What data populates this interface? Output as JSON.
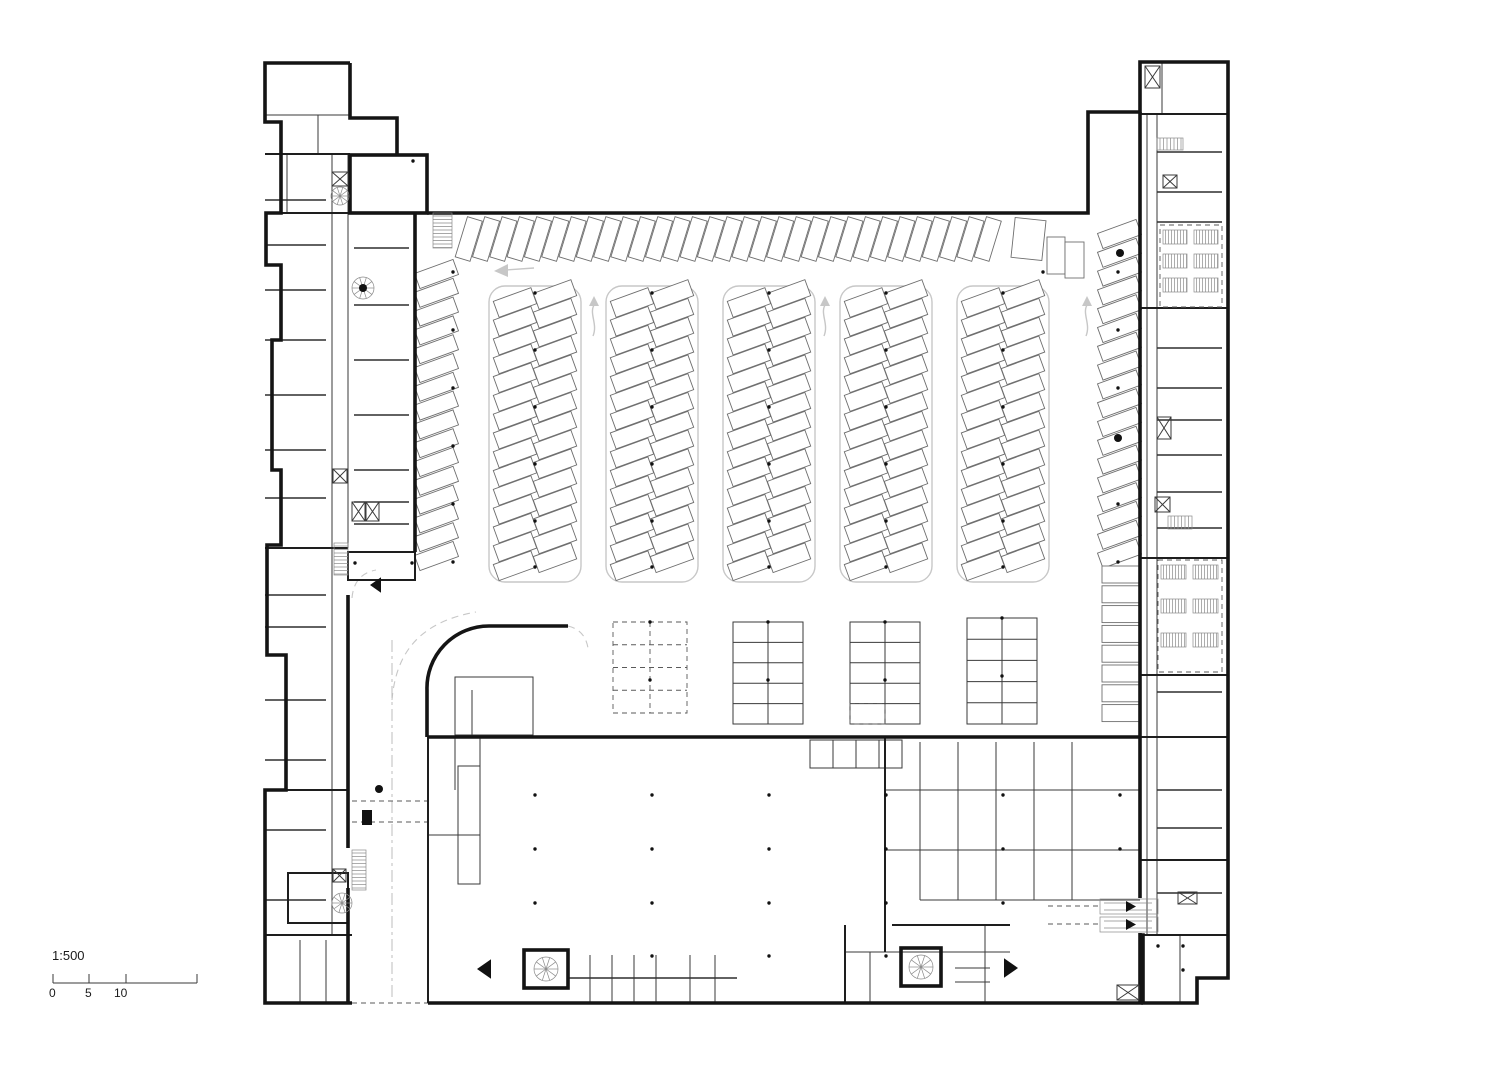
{
  "meta": {
    "drawing_type": "architectural floor plan, parking level",
    "background": "#ffffff",
    "ink": "#141414",
    "light_gray": "#c7c7c7"
  },
  "scale_bar": {
    "ratio": "1:500",
    "ticks": [
      "0",
      "5",
      "10"
    ],
    "bar": {
      "x1": 53,
      "x2": 197,
      "y": 983,
      "tick_xs": [
        53,
        89,
        126,
        197
      ],
      "tick_h": 9
    }
  },
  "plan": {
    "paths4": [
      "M350,63 H265 V122 H281 V213 H266 V265 H281 V340 H272 V470 H281 V545 H267 V655 H286 V790 H265 V1003 H352",
      "M350,63 V118 H397 V155",
      "M427,213 H1088 V112 H1140 V62 H1228 V978 H1197 V1003 H1143 V935 H1140",
      "M1140,112 V898 M1140,933 V1003",
      "M415,213 V552",
      "M428,1003 H1143",
      "M348,595 V848 M348,888 V1003",
      "M427,690 A62,62 0 0 1 489,626 M489,626 H568 M427,690 V737",
      "M428,737 H1140"
    ],
    "r4": [
      [
        350,
        155,
        77,
        58
      ],
      [
        524,
        950,
        44,
        38
      ],
      [
        901,
        948,
        40,
        38
      ]
    ],
    "w2": [
      [
        428,
        737,
        428,
        1003
      ],
      [
        265,
        213,
        415,
        213
      ],
      [
        265,
        154,
        350,
        154
      ],
      [
        265,
        548,
        348,
        548
      ],
      [
        265,
        790,
        348,
        790
      ],
      [
        265,
        935,
        352,
        935
      ],
      [
        1140,
        114,
        1228,
        114
      ],
      [
        1140,
        308,
        1228,
        308
      ],
      [
        1140,
        558,
        1228,
        558
      ],
      [
        1140,
        675,
        1228,
        675
      ],
      [
        1140,
        737,
        1228,
        737
      ],
      [
        1140,
        860,
        1228,
        860
      ],
      [
        1140,
        935,
        1228,
        935
      ],
      [
        885,
        737,
        885,
        952
      ],
      [
        845,
        925,
        845,
        1003
      ],
      [
        892,
        925,
        1010,
        925
      ]
    ],
    "r2": [
      [
        288,
        873,
        60,
        50
      ],
      [
        348,
        552,
        67,
        28
      ]
    ],
    "w1": [
      [
        332,
        155,
        332,
        935
      ],
      [
        348,
        155,
        348,
        548
      ],
      [
        1147,
        114,
        1147,
        935
      ],
      [
        1157,
        114,
        1157,
        935
      ],
      [
        265,
        115,
        350,
        115
      ],
      [
        318,
        115,
        318,
        155
      ],
      [
        287,
        154,
        287,
        213
      ],
      [
        1162,
        62,
        1162,
        114
      ],
      [
        455,
        737,
        455,
        790
      ],
      [
        480,
        737,
        480,
        835
      ],
      [
        428,
        835,
        480,
        835
      ],
      [
        590,
        955,
        590,
        1003
      ],
      [
        612,
        955,
        612,
        1003
      ],
      [
        634,
        955,
        634,
        1003
      ],
      [
        656,
        955,
        656,
        1003
      ],
      [
        690,
        955,
        690,
        1003
      ],
      [
        715,
        955,
        715,
        1003
      ],
      [
        845,
        952,
        1010,
        952
      ],
      [
        870,
        952,
        870,
        1003
      ],
      [
        985,
        925,
        985,
        1003
      ],
      [
        920,
        742,
        920,
        900
      ],
      [
        958,
        742,
        958,
        900
      ],
      [
        996,
        742,
        996,
        900
      ],
      [
        1034,
        742,
        1034,
        900
      ],
      [
        1072,
        742,
        1072,
        900
      ],
      [
        885,
        790,
        1140,
        790
      ],
      [
        885,
        850,
        1140,
        850
      ],
      [
        920,
        900,
        1140,
        900
      ],
      [
        300,
        940,
        300,
        1003
      ],
      [
        326,
        940,
        326,
        1003
      ],
      [
        1180,
        935,
        1180,
        1003
      ],
      [
        833,
        740,
        833,
        768
      ],
      [
        856,
        740,
        856,
        768
      ],
      [
        879,
        740,
        879,
        768
      ],
      [
        472,
        690,
        472,
        737
      ],
      [
        955,
        968,
        990,
        968
      ],
      [
        955,
        982,
        990,
        982
      ]
    ],
    "r1": [
      [
        458,
        766,
        22,
        118
      ],
      [
        810,
        740,
        92,
        28
      ],
      [
        455,
        677,
        78,
        58
      ]
    ],
    "divGroups": [
      {
        "x1": 265,
        "x2": 326,
        "ys": [
          200,
          245,
          290,
          340,
          395,
          450,
          498,
          595,
          627,
          700,
          760,
          830,
          900
        ]
      },
      {
        "x1": 354,
        "x2": 409,
        "ys": [
          248,
          305,
          360,
          415,
          470,
          502,
          524
        ]
      },
      {
        "x1": 1157,
        "x2": 1222,
        "ys": [
          152,
          192,
          222,
          348,
          388,
          420,
          455,
          492,
          528,
          692,
          790,
          828,
          893
        ]
      },
      {
        "x1": 568,
        "x2": 737,
        "ys": [
          978
        ]
      }
    ],
    "islands": {
      "cx": [
        535,
        652,
        769,
        886,
        1003
      ],
      "outline": {
        "y": 286,
        "h": 296,
        "w": 92,
        "rx": 16
      },
      "stall_len": 40,
      "stall_wid": 17,
      "pitch": 18.8,
      "angle": -20,
      "left_y0": 294,
      "right_y0": 286,
      "count": 15,
      "dots_y": [
        293,
        350,
        407,
        464,
        521,
        567
      ]
    },
    "rows": [
      {
        "dir": "x",
        "x": 461,
        "y": 218,
        "len": 42,
        "wid": 15.5,
        "count": 31,
        "pitch": 17.3,
        "angle": 17
      },
      {
        "dir": "y",
        "x": 416,
        "y": 266,
        "len": 41,
        "wid": 16,
        "count": 16,
        "pitch": 18.8,
        "angle": -20
      },
      {
        "dir": "y",
        "x": 1099,
        "y": 226,
        "len": 41,
        "wid": 16,
        "count": 18,
        "pitch": 18.8,
        "angle": -20
      },
      {
        "dir": "y",
        "x": 1102,
        "y": 566,
        "len": 38,
        "wid": 17,
        "count": 8,
        "pitch": 19.8,
        "angle": 0
      }
    ],
    "misc_stalls": [
      {
        "x": 1013,
        "y": 219,
        "w": 31,
        "h": 40,
        "a": 6
      },
      {
        "x": 1047,
        "y": 237,
        "w": 18,
        "h": 37,
        "a": 0
      },
      {
        "x": 1065,
        "y": 242,
        "w": 19,
        "h": 36,
        "a": 0
      }
    ],
    "tables": [
      {
        "x": 613,
        "y": 622,
        "w": 74,
        "h": 91,
        "rows": 4,
        "dashed": true,
        "dashedBottom": false
      },
      {
        "x": 733,
        "y": 622,
        "w": 70,
        "h": 102,
        "rows": 5,
        "dashed": false,
        "dashedBottom": false
      },
      {
        "x": 850,
        "y": 622,
        "w": 70,
        "h": 102,
        "rows": 5,
        "dashed": false,
        "dashedBottom": true
      },
      {
        "x": 967,
        "y": 618,
        "w": 70,
        "h": 106,
        "rows": 5,
        "dashed": false,
        "dashedBottom": false
      }
    ],
    "dots": {
      "grids": [
        {
          "xs": [
            535,
            652,
            769,
            886,
            1003
          ],
          "ys": [
            795,
            849,
            903
          ]
        },
        {
          "xs": [
            652,
            769,
            886
          ],
          "ys": [
            956
          ]
        },
        {
          "xs": [
            453
          ],
          "ys": [
            272,
            330,
            388,
            446,
            504,
            562
          ]
        },
        {
          "xs": [
            1118
          ],
          "ys": [
            272,
            330,
            388,
            504,
            562
          ]
        },
        {
          "xs": [
            1120
          ],
          "ys": [
            795,
            849
          ]
        },
        {
          "xs": [
            650,
            768,
            885
          ],
          "ys": [
            622,
            680
          ]
        },
        {
          "xs": [
            1002
          ],
          "ys": [
            618,
            676
          ]
        }
      ],
      "pts": [
        [
          413,
          161
        ],
        [
          355,
          563
        ],
        [
          412,
          563
        ],
        [
          1043,
          272
        ],
        [
          1158,
          946
        ],
        [
          1183,
          946
        ],
        [
          1183,
          970
        ]
      ],
      "big": [
        [
          1120,
          253
        ],
        [
          1118,
          438
        ],
        [
          379,
          789
        ],
        [
          363,
          288
        ]
      ]
    },
    "elevators": [
      [
        332,
        172,
        16,
        14
      ],
      [
        333,
        469,
        14,
        14
      ],
      [
        352,
        502,
        13,
        19
      ],
      [
        366,
        502,
        13,
        19
      ],
      [
        333,
        869,
        13,
        13
      ],
      [
        1145,
        66,
        15,
        22
      ],
      [
        1163,
        175,
        14,
        13
      ],
      [
        1157,
        417,
        14,
        22
      ],
      [
        1155,
        497,
        15,
        15
      ],
      [
        1178,
        892,
        19,
        12
      ],
      [
        1117,
        985,
        22,
        15
      ]
    ],
    "stairs": [
      {
        "x": 433,
        "y": 213,
        "w": 19,
        "h": 35,
        "dir": "v"
      },
      {
        "x": 334,
        "y": 543,
        "w": 14,
        "h": 32,
        "dir": "v"
      },
      {
        "x": 352,
        "y": 850,
        "w": 14,
        "h": 40,
        "dir": "v"
      },
      {
        "x": 1157,
        "y": 138,
        "w": 26,
        "h": 12,
        "dir": "h"
      },
      {
        "x": 1168,
        "y": 516,
        "w": 24,
        "h": 13,
        "dir": "h"
      }
    ],
    "spirals": [
      [
        340,
        196,
        9
      ],
      [
        363,
        288,
        11
      ],
      [
        342,
        903,
        10
      ],
      [
        546,
        969,
        12
      ],
      [
        921,
        967,
        12
      ]
    ],
    "triangles": [
      {
        "x": 370,
        "y": 585,
        "s": 11,
        "d": "l"
      },
      {
        "x": 477,
        "y": 969,
        "s": 14,
        "d": "l"
      },
      {
        "x": 1018,
        "y": 968,
        "s": 14,
        "d": "r"
      }
    ],
    "arrows_up": [
      593,
      824,
      1086
    ],
    "arrow_left": {
      "tipx": 494,
      "tipy": 271
    },
    "hatch_zones": [
      {
        "x": 1160,
        "y": 225,
        "w": 62,
        "h": 82
      },
      {
        "x": 1158,
        "y": 560,
        "w": 64,
        "h": 112
      }
    ],
    "light_dash": [
      [
        352,
        801,
        428,
        801
      ],
      [
        352,
        822,
        428,
        822
      ],
      [
        1048,
        906,
        1100,
        906
      ],
      [
        1048,
        924,
        1100,
        924
      ],
      [
        352,
        1003,
        428,
        1003
      ]
    ],
    "light_paths": [
      "M392,700 C396,652 420,622 476,612",
      "M568,626 Q585,630 588,648",
      "M352,598 Q354,574 376,570"
    ],
    "dashdot": [
      [
        392,
        640,
        392,
        1000
      ]
    ],
    "gate": [
      362,
      810,
      10,
      15
    ],
    "escalators": [
      {
        "x": 1100,
        "y": 899,
        "w": 58,
        "h": 15
      },
      {
        "x": 1100,
        "y": 917,
        "w": 58,
        "h": 15
      }
    ]
  }
}
